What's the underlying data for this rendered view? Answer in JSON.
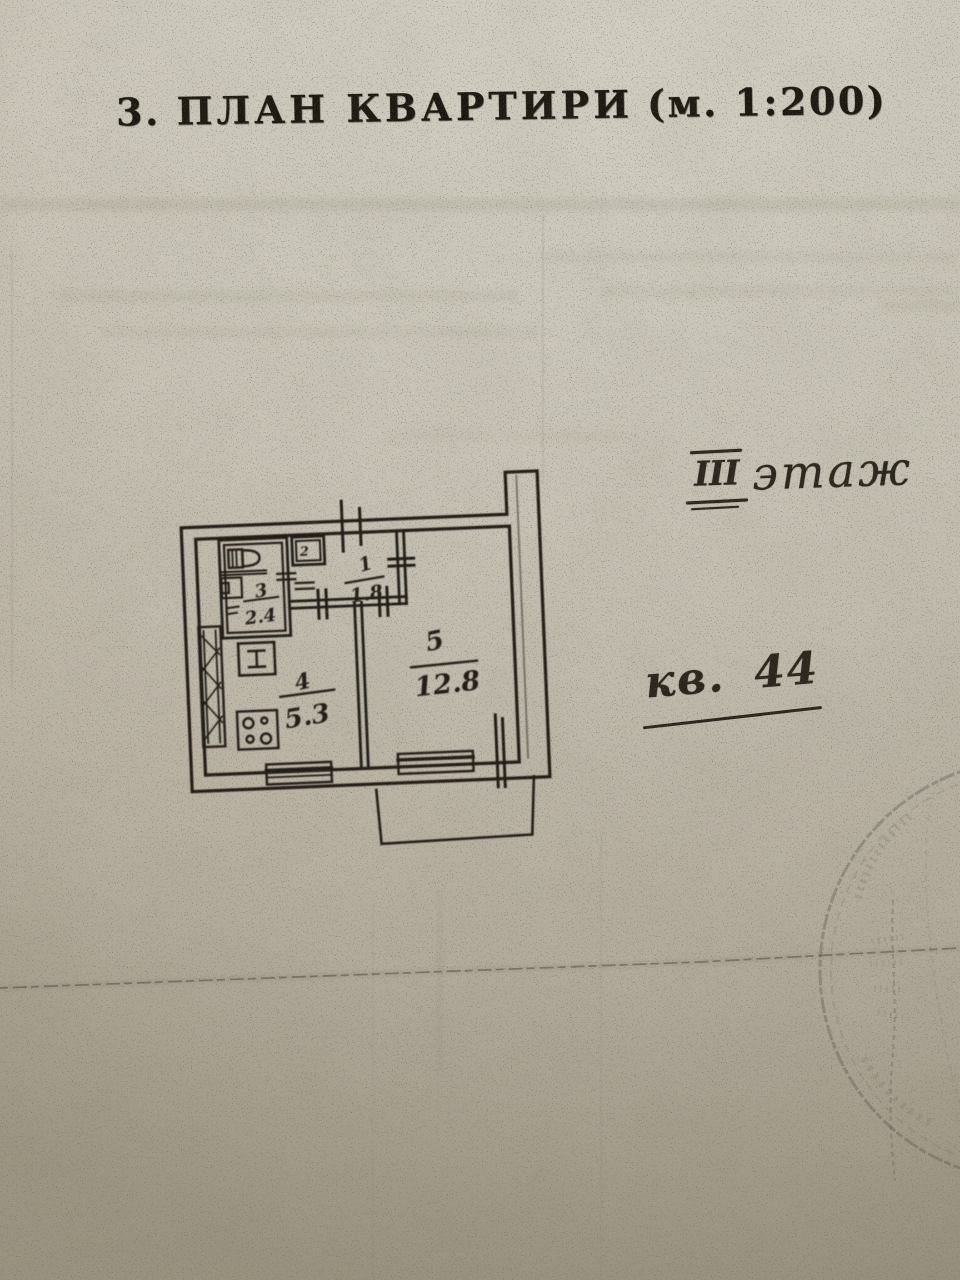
{
  "document": {
    "section_number": "3.",
    "title": "ПЛАН КВАРТИРИ",
    "scale": "(м. 1:200)"
  },
  "annotations": {
    "floor_numeral": "III",
    "floor_label": "этаж",
    "apartment_label": "кв. 44"
  },
  "plan": {
    "rooms": [
      {
        "number": "1",
        "area": "1.8"
      },
      {
        "number": "2",
        "area": ""
      },
      {
        "number": "3",
        "area": "2.4"
      },
      {
        "number": "4",
        "area": "5.3"
      },
      {
        "number": "5",
        "area": "12.8"
      }
    ]
  },
  "colors": {
    "paper": "#c9c4b7",
    "ink": "#221e17",
    "stamp": "#57564a"
  }
}
